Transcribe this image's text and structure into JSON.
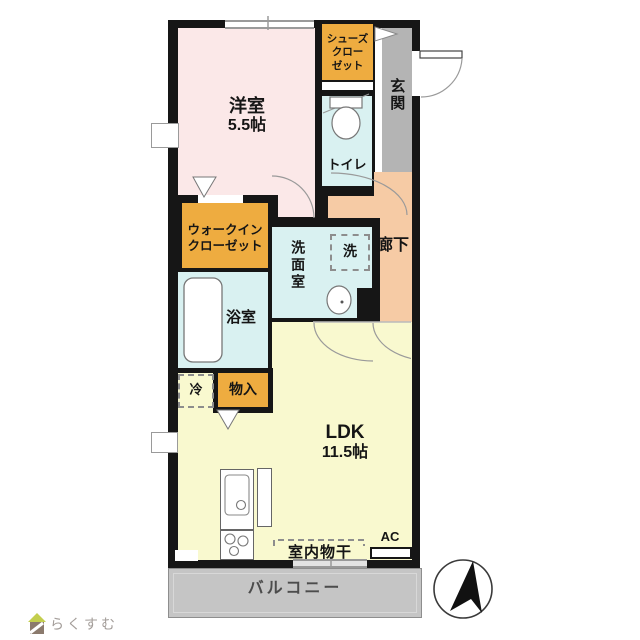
{
  "plan": {
    "rooms": {
      "western_room": {
        "label": "洋室",
        "size": "5.5帖"
      },
      "shoe_closet": {
        "line1": "シューズ",
        "line2": "クロー",
        "line3": "ゼット"
      },
      "entrance": {
        "label": "玄関"
      },
      "toilet": {
        "label": "トイレ"
      },
      "hallway": {
        "label": "廊下"
      },
      "walk_in_closet": {
        "line1": "ウォークイン",
        "line2": "クローゼット"
      },
      "washroom": {
        "label": "洗面室"
      },
      "washer_space": {
        "label": "洗"
      },
      "bathroom": {
        "label": "浴室"
      },
      "fridge_space": {
        "label": "冷"
      },
      "storage": {
        "label": "物入"
      },
      "ldk": {
        "label": "LDK",
        "size": "11.5帖"
      },
      "indoor_drying": {
        "label": "室内物干"
      },
      "air_conditioner": {
        "label": "AC"
      },
      "balcony": {
        "label": "バルコニー"
      }
    },
    "colors": {
      "wall": "#161616",
      "western_room": "#fbe8e8",
      "closet_orange": "#eeac40",
      "entrance_gray": "#b4b4b4",
      "wet_area_cyan": "#d9f1f1",
      "hallway_peach": "#f6cba5",
      "ldk_yellow": "#f9f9cf",
      "balcony_gray": "#c5c5c5"
    },
    "icons": {
      "compass": "north-arrow",
      "toilet_fixture": "toilet-icon",
      "bathtub_fixture": "bathtub-icon",
      "sink_fixture": "sink-icon",
      "kitchen_fixture": "kitchen-stove-icon"
    }
  },
  "footer": {
    "logo_text": "らくすむ",
    "logo_icon": "house-logo-icon"
  }
}
